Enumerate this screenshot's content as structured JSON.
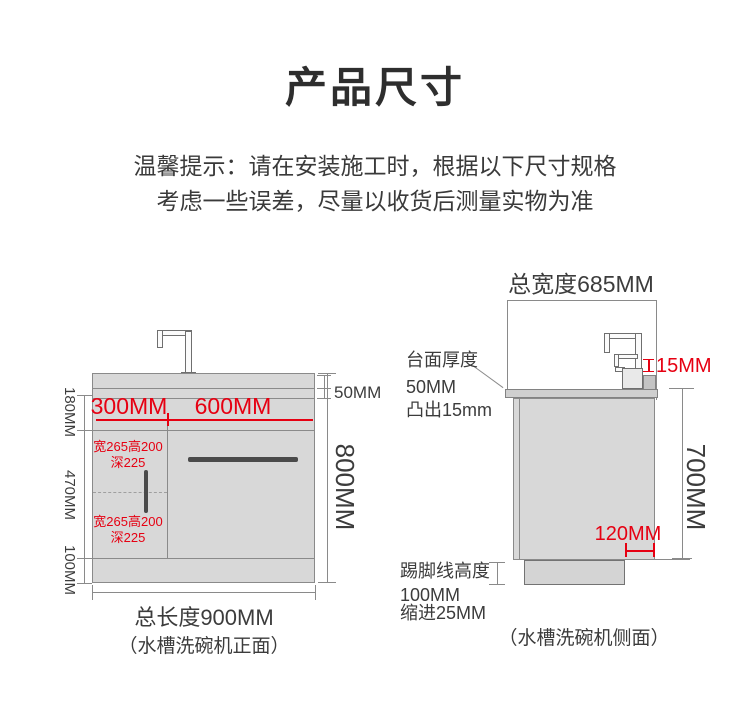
{
  "title": "产品尺寸",
  "notice": {
    "line1": "温馨提示：请在安装施工时，根据以下尺寸规格",
    "line2": "考虑一些误差，尽量以收货后测量实物为准"
  },
  "front_view": {
    "top_width_left": "300MM",
    "top_width_right": "600MM",
    "countertop_thickness": "50MM",
    "upper_section_height": "180MM",
    "middle_section_height": "470MM",
    "kick_section_height": "100MM",
    "total_height": "800MM",
    "inner_note_top": {
      "line1": "宽265高200",
      "line2": "深225"
    },
    "inner_note_bottom": {
      "line1": "宽265高200",
      "line2": "深225"
    },
    "total_length": "总长度900MM",
    "caption": "（水槽洗碗机正面）"
  },
  "side_view": {
    "total_width": "总宽度685MM",
    "back_ledge_height": "15MM",
    "countertop_note": {
      "line1": "台面厚度",
      "line2": "50MM",
      "line3": "凸出15mm"
    },
    "body_height": "700MM",
    "kick_inset_right": "120MM",
    "kick_note": {
      "line1": "踢脚线高度",
      "line2": "100MM",
      "line3": "缩进25MM"
    },
    "caption": "（水槽洗碗机侧面）"
  },
  "colors": {
    "accent_red": "#e60012",
    "text_dark": "#3c3c3c",
    "cabinet_fill": "#d8d8d8",
    "line_gray": "#8a8a8a"
  }
}
